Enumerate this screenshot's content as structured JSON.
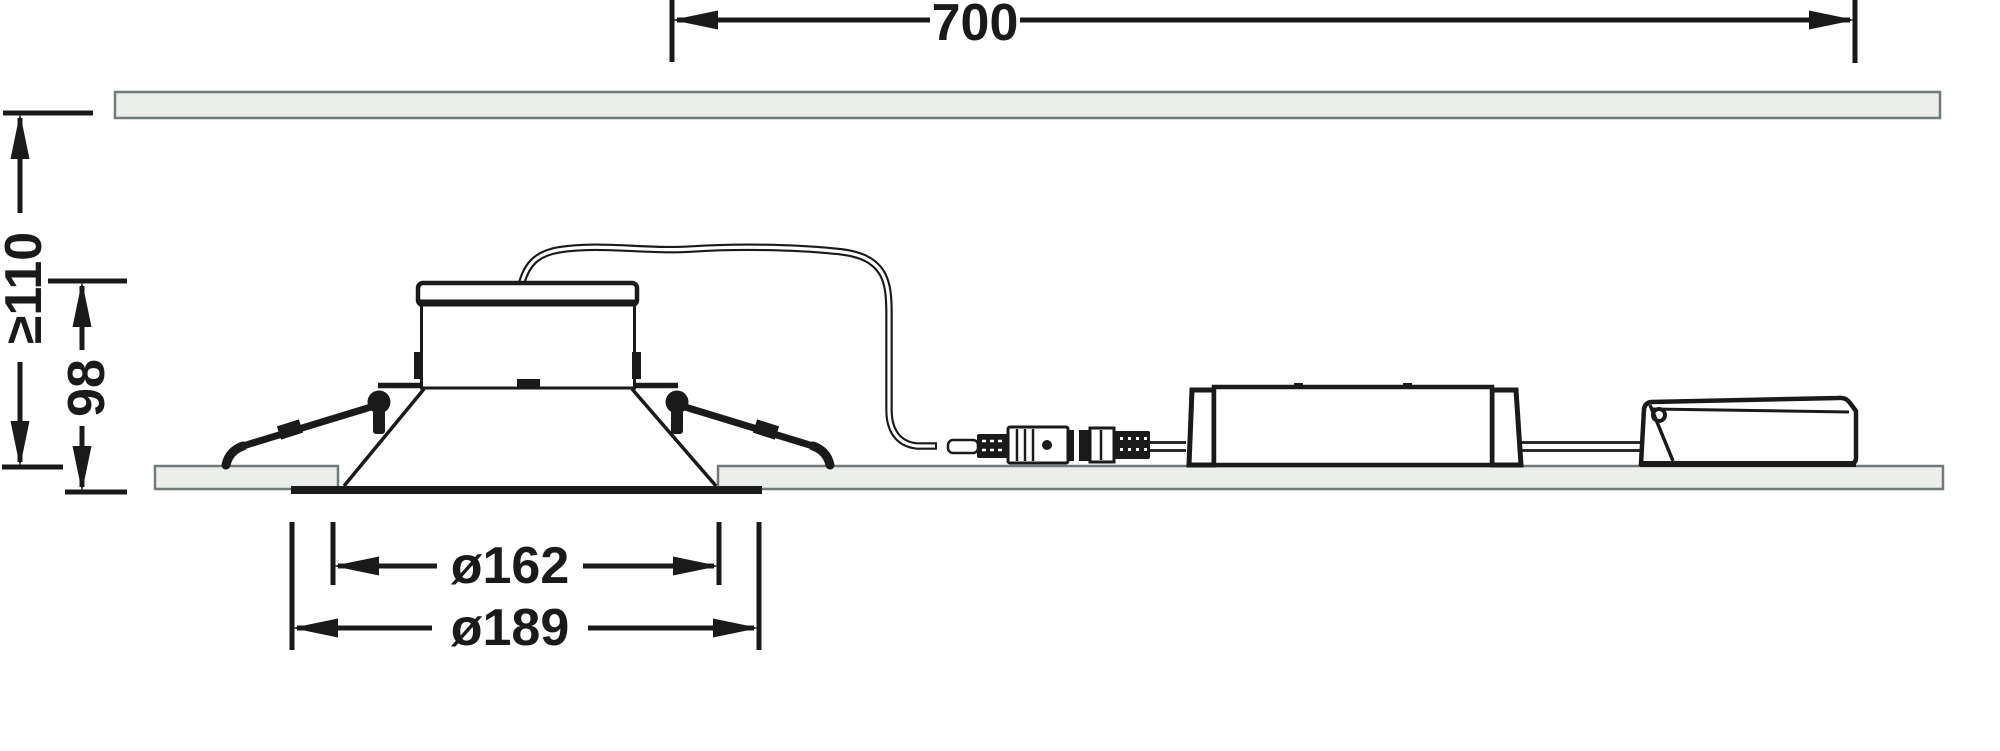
{
  "dimensions": {
    "cable_length": "700",
    "recess_depth": "≥110",
    "fixture_height": "98",
    "cutout_diameter": "ø162",
    "outer_diameter": "ø189"
  },
  "colors": {
    "line": "#1a1a1a",
    "panel_fill": "#eceeec",
    "panel_border": "#6f7b7b",
    "background": "#ffffff"
  }
}
